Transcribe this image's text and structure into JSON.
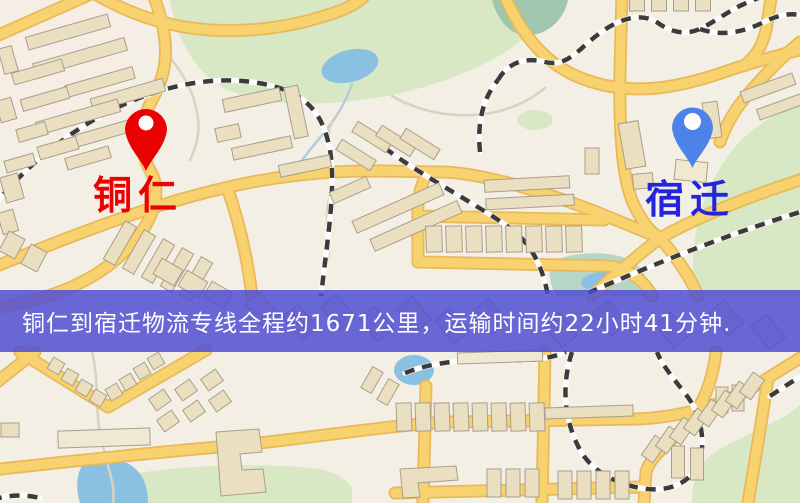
{
  "map": {
    "origin": {
      "label": "铜仁",
      "marker_color": "#e80202",
      "label_color": "#ea0202"
    },
    "destination": {
      "label": "宿迁",
      "marker_color": "#4d82e8",
      "label_color": "#2424dc"
    },
    "route_banner": {
      "text": "铜仁到宿迁物流专线全程约1671公里，运输时间约22小时41分钟.",
      "distance_km": "1671",
      "duration": "22小时41分钟"
    }
  },
  "css_vars": {
    "banner-bg": "rgba(80,78,210,0.85)",
    "banner-text-color": "#ffffff",
    "origin-label-color": "#ea0202",
    "dest-label-color": "#2424dc",
    "map-bg": "#f4efe4",
    "road-fill": "#f8d26e",
    "road-casing": "#e8b95b",
    "park": "#d8e7c4",
    "water": "#8ac0e2",
    "building": "#eadfc1",
    "building-outline": "#a89f8b",
    "railway-dash": "#3b3b3b"
  }
}
